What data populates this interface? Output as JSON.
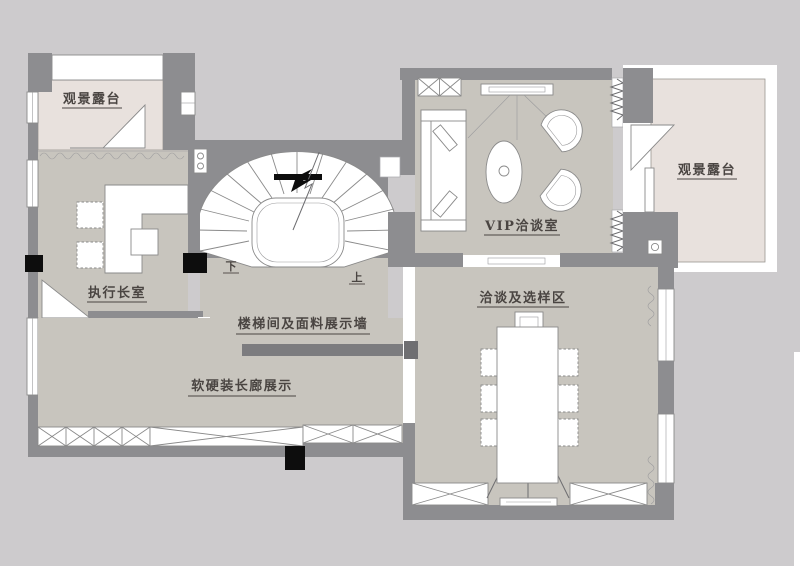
{
  "plan": {
    "title": "floor-plan",
    "labels": {
      "terrace_left": "观景露台",
      "office": "执行长室",
      "stair_wall": "楼梯间及面料展示墙",
      "gallery": "软硬装长廊展示",
      "vip": "VIP洽谈室",
      "terrace_right": "观景露台",
      "negotiation": "洽谈及选样区",
      "stair_down": "下",
      "stair_up": "上"
    },
    "colors": {
      "background": "#cdcbcd",
      "wall": "#8d8d90",
      "floor": "#c8c5be",
      "terrace": "#e8e1dd",
      "column": "#0d0d0d",
      "text": "#4a4542"
    }
  }
}
